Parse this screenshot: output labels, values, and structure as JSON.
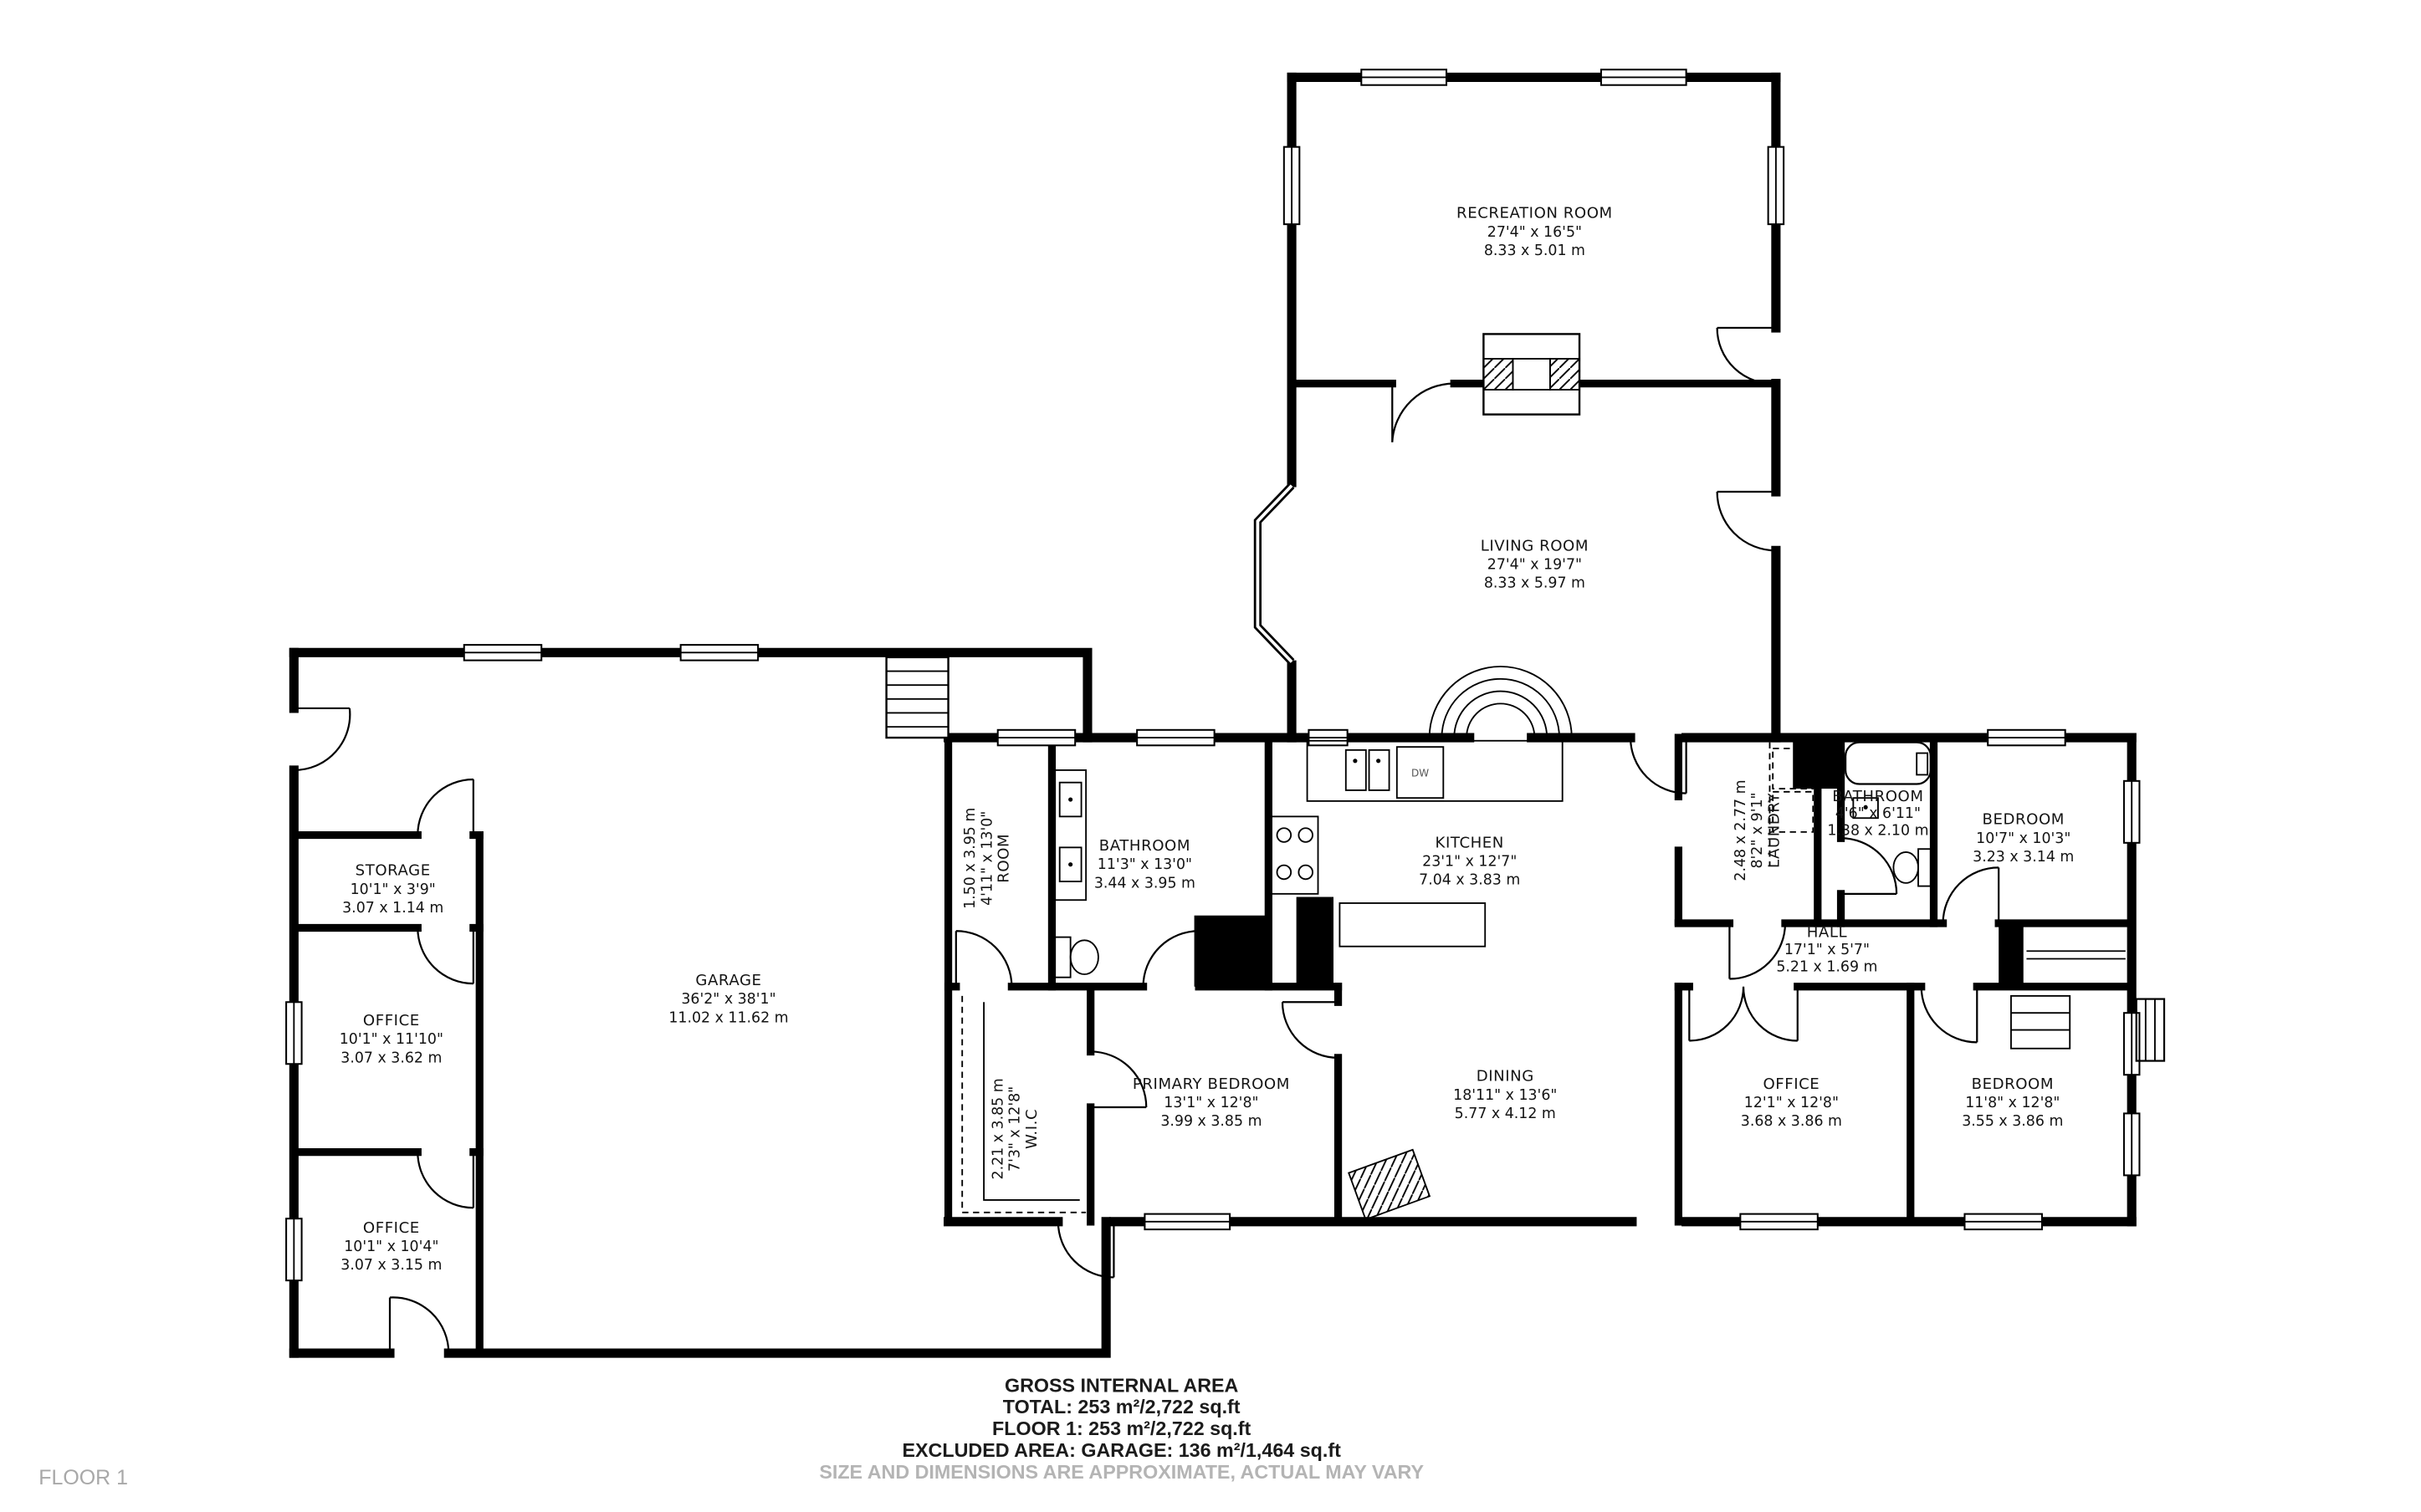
{
  "rooms": [
    {
      "name": "RECREATION ROOM",
      "imperial": "27'4\" x 16'5\"",
      "metric": "8.33 x 5.01 m"
    },
    {
      "name": "LIVING ROOM",
      "imperial": "27'4\" x 19'7\"",
      "metric": "8.33 x 5.97 m"
    },
    {
      "name": "KITCHEN",
      "imperial": "23'1\" x 12'7\"",
      "metric": "7.04 x 3.83 m"
    },
    {
      "name": "BATHROOM",
      "imperial": "11'3\" x 13'0\"",
      "metric": "3.44 x 3.95 m"
    },
    {
      "name": "ROOM",
      "imperial": "4'11\" x 13'0\"",
      "metric": "1.50 x 3.95 m"
    },
    {
      "name": "LAUNDRY",
      "imperial": "8'2\" x 9'1\"",
      "metric": "2.48 x 2.77 m"
    },
    {
      "name": "BATHROOM",
      "imperial": "4'6\" x 6'11\"",
      "metric": "1.38 x 2.10 m"
    },
    {
      "name": "BEDROOM",
      "imperial": "10'7\" x 10'3\"",
      "metric": "3.23 x 3.14 m"
    },
    {
      "name": "HALL",
      "imperial": "17'1\" x 5'7\"",
      "metric": "5.21 x 1.69 m"
    },
    {
      "name": "STORAGE",
      "imperial": "10'1\" x 3'9\"",
      "metric": "3.07 x 1.14 m"
    },
    {
      "name": "OFFICE",
      "imperial": "10'1\" x 11'10\"",
      "metric": "3.07 x 3.62 m"
    },
    {
      "name": "OFFICE",
      "imperial": "10'1\" x 10'4\"",
      "metric": "3.07 x 3.15 m"
    },
    {
      "name": "GARAGE",
      "imperial": "36'2\" x 38'1\"",
      "metric": "11.02 x 11.62 m"
    },
    {
      "name": "W.I.C",
      "imperial": "7'3\" x 12'8\"",
      "metric": "2.21 x 3.85 m"
    },
    {
      "name": "PRIMARY BEDROOM",
      "imperial": "13'1\" x 12'8\"",
      "metric": "3.99 x 3.85 m"
    },
    {
      "name": "DINING",
      "imperial": "18'11\" x 13'6\"",
      "metric": "5.77 x 4.12 m"
    },
    {
      "name": "OFFICE",
      "imperial": "12'1\" x 12'8\"",
      "metric": "3.68 x 3.86 m"
    },
    {
      "name": "BEDROOM",
      "imperial": "11'8\" x 12'8\"",
      "metric": "3.55 x 3.86 m"
    }
  ],
  "appliance_labels": {
    "dishwasher": "DW"
  },
  "footer": {
    "line1": "GROSS INTERNAL AREA",
    "line2": "TOTAL: 253 m²/2,722 sq.ft",
    "line3": "FLOOR 1: 253 m²/2,722 sq.ft",
    "line4": "EXCLUDED AREA: GARAGE: 136 m²/1,464 sq.ft",
    "disclaimer": "SIZE AND DIMENSIONS ARE APPROXIMATE, ACTUAL MAY VARY"
  },
  "floor_label": "FLOOR 1",
  "colors": {
    "wall": "#000000",
    "text": "#141414",
    "muted_text": "#a8a8a8",
    "background": "#ffffff"
  }
}
